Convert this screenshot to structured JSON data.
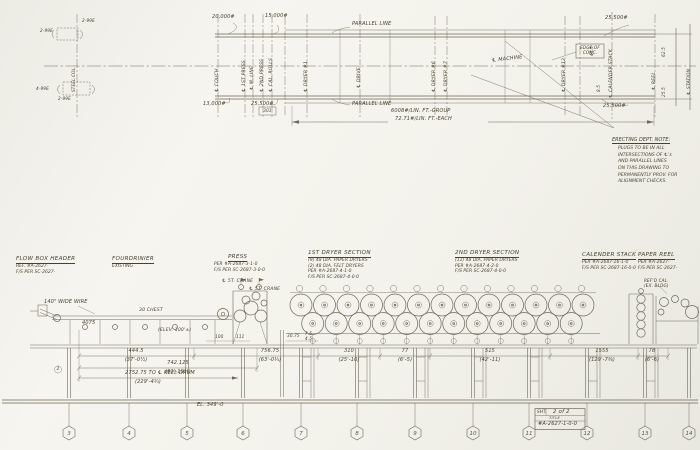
{
  "plan": {
    "labels": {
      "parallel_top": "PARALLEL LINE",
      "parallel_bottom": "PARALLEL LINE",
      "machine_cl": "℄ MACHINE",
      "edge_of_conc_1": "EDGE OF",
      "edge_of_conc_2": "CONC.",
      "load_group": "6008#/LIN. FT.-GROUP",
      "load_each": "72.71#/LIN. FT.-EACH",
      "w_20000": "20,000#",
      "w_15000": "15,000#",
      "w_13000": "13,000#",
      "w_25500_a": "25,500#",
      "w_25500_b": "25,500#",
      "w_25500_c": "25,500#",
      "box_301": "301",
      "steel_col": "STEEL COL.",
      "det_a": "2-99E",
      "det_b": "2-99E",
      "det_c": "4-99E",
      "det_d": "2-99E"
    },
    "small_dims": [
      "45.5",
      "8.5",
      "62.5",
      "25.5"
    ],
    "centerlines": [
      "℄ COUCH",
      "℄ 1ST PRESS",
      "℄ M. LINE",
      "℄ 2ND PRESS",
      "℄ CAL. ROLLS",
      "℄ DRYER #1",
      "℄ DRIVE",
      "℄ DRYER #6",
      "℄ DRYER #7",
      "℄ DRYER #12",
      "℄ CALENDER STACK",
      "℄ REEL",
      "℄ STATION"
    ]
  },
  "note": {
    "title": "ERECTING DEPT. NOTE:",
    "lines": [
      "PLUGS TO BE IN ALL",
      "INTERSECTIONS OF ℄'s",
      "AND PARALLEL LINES",
      "ON THIS DRAWING TO",
      "PERMANENTLY PROV. FOR",
      "ALIGNMENT CHECKS."
    ]
  },
  "sections": [
    {
      "t": "FLOW BOX HEADER",
      "lines": [
        "REF. #A-2627-",
        "F/S PER SC-2627-"
      ]
    },
    {
      "t": "FOURDRINIER",
      "lines": [
        "EXISTING"
      ]
    },
    {
      "t": "PRESS",
      "lines": [
        "PER #A-2687-3-1-0",
        "F/S PER SC-2687-3-0-0"
      ]
    },
    {
      "t": "1ST DRYER SECTION",
      "lines": [
        "(9) 48 DIA. PAPER DRYERS",
        "(2) 48 DIA. FELT DRYERS",
        "PER #A-2687-4-1-0",
        "F/S PER SC-2687-4-0-0"
      ]
    },
    {
      "t": "2ND DRYER SECTION",
      "lines": [
        "(11) 48 DIA. PAPER DRYERS",
        "PER #A-2687-4-2-0",
        "F/S PER SC-2687-4-0-0"
      ]
    },
    {
      "t": "CALENDER STACK",
      "lines": [
        "PER #A-2687-16-1-0",
        "F/S PER SC-2687-16-0-0"
      ]
    },
    {
      "t": "PAPER REEL",
      "lines": [
        "PER #A-2627-",
        "F/S PER SC-2627-"
      ]
    }
  ],
  "elevation": {
    "labels": {
      "wire": "140\" WIDE WIRE",
      "chest": "30 CHEST",
      "crane1": "℄ 5T. CRANE",
      "crane2": "℄ 5T. CRANE",
      "elev100": "(ELEV. 100'±)",
      "el349": "EL. 349'-0",
      "d4075": "4075",
      "refd_cal": "REF'D CAL.",
      "ex_bldg": "(EX. BLDG)",
      "circ2": "2"
    },
    "dims": [
      {
        "v": "444.5",
        "f": "(37'-0½)"
      },
      {
        "v": "742.125",
        "f": "(61'-10⅛)"
      },
      {
        "v": "2752.75 TO ℄ REEL DRUM",
        "f": "(229'-4¾)"
      },
      {
        "v": "756.75",
        "f": "(63'-0¾)"
      },
      {
        "v": "310",
        "f": "(25'-10)"
      },
      {
        "v": "77",
        "f": "(6'-5)"
      },
      {
        "v": "515",
        "f": "(42'-11)"
      },
      {
        "v": "1555",
        "f": "(129'-7⅜)"
      },
      {
        "v": "78",
        "f": "(6'-6)"
      }
    ],
    "small_dims": [
      "100",
      "111",
      "30.75",
      "7.5",
      "4.5"
    ]
  },
  "titleblock": {
    "sht_label": "SHT.",
    "sheet": "2 of 2",
    "title_word": "TITLE",
    "number": "#A-2627-1-0-0"
  },
  "columns": {
    "markers": [
      "3",
      "4",
      "5",
      "6",
      "7",
      "8",
      "9",
      "10",
      "11",
      "12",
      "13",
      "14"
    ]
  }
}
